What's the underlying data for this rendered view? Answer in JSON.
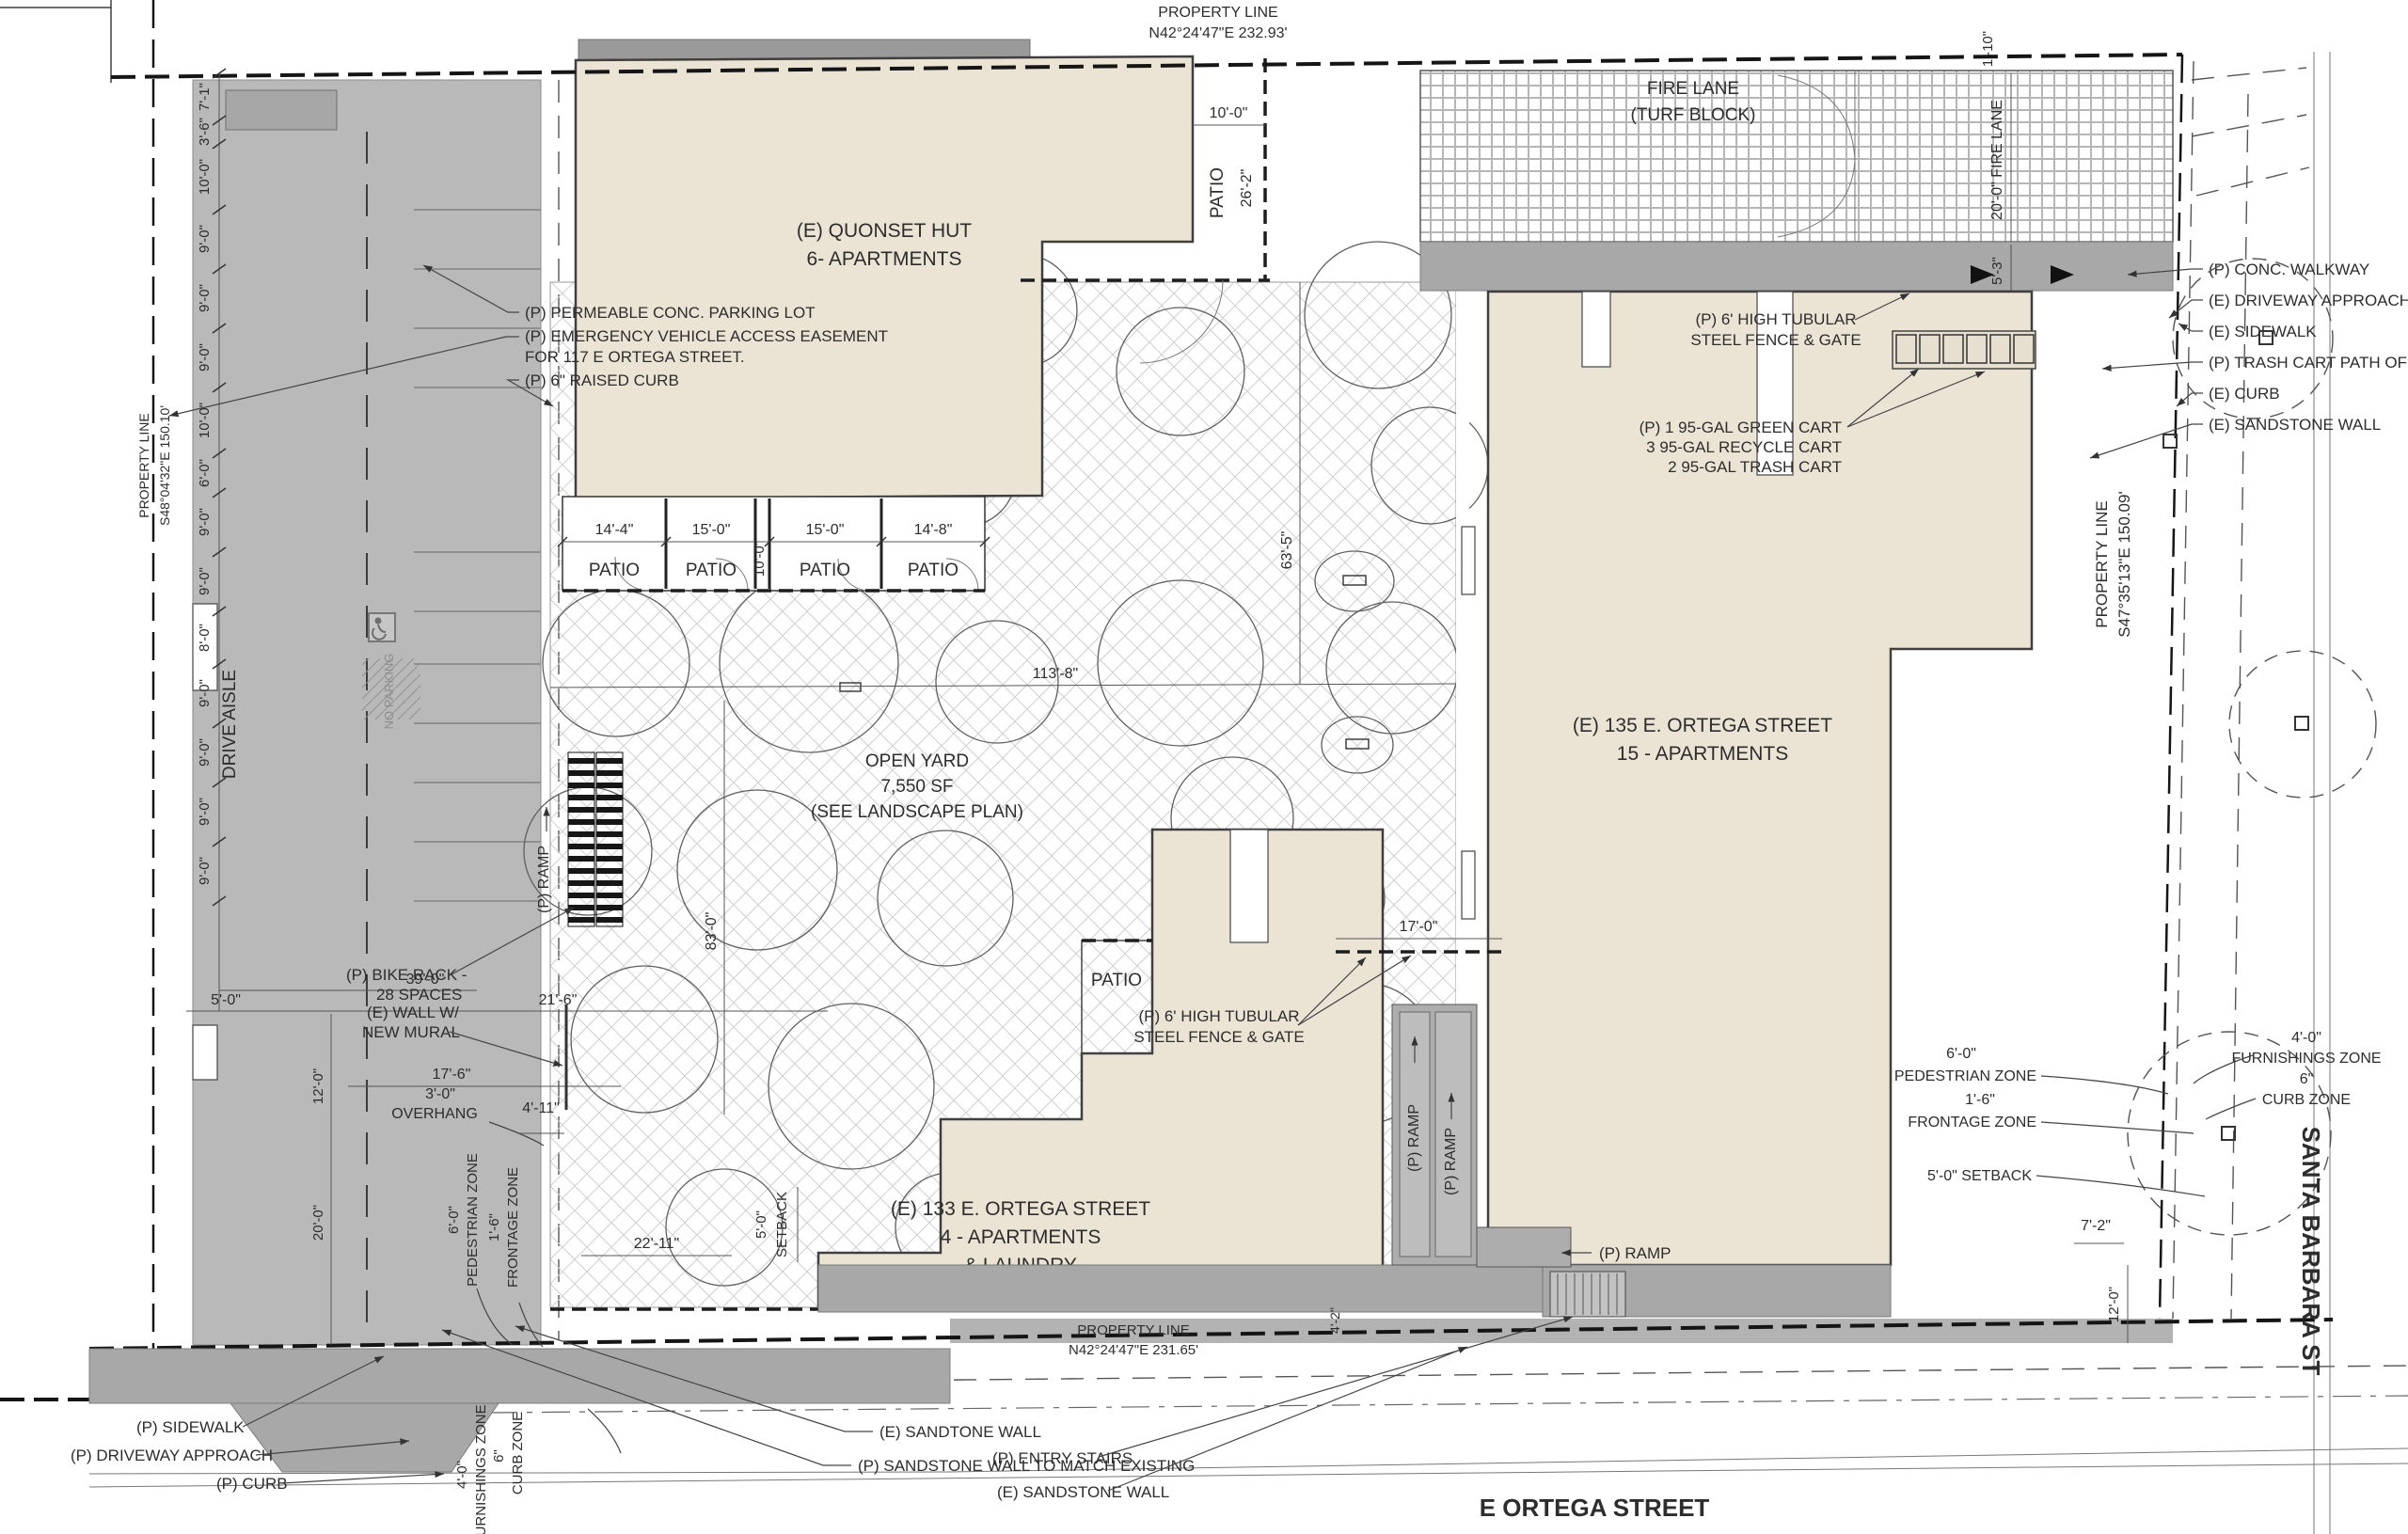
{
  "drawing": {
    "property_lines": {
      "label": "PROPERTY LINE",
      "top_bearing": "N42°24'47\"E 232.93'",
      "bottom_bearing": "N42°24'47\"E 231.65'",
      "left_bearing": "S48°04'32\"E 150.10'",
      "right_bearing": "S47°35'13\"E 150.09'"
    },
    "streets": {
      "bottom": "E ORTEGA STREET",
      "right": "SANTA BARBARA ST"
    },
    "buildings": {
      "quonset_line1": "(E) QUONSET HUT",
      "quonset_line2": "6- APARTMENTS",
      "b135_line1": "(E) 135 E. ORTEGA STREET",
      "b135_line2": "15 - APARTMENTS",
      "b133_line1": "(E) 133 E. ORTEGA STREET",
      "b133_line2": "4 - APARTMENTS",
      "b133_line3": "& LAUNDRY"
    },
    "areas": {
      "fire_lane1": "FIRE LANE",
      "fire_lane2": "(TURF BLOCK)",
      "open_yard1": "OPEN YARD",
      "open_yard2": "7,550 SF",
      "open_yard3": "(SEE LANDSCAPE PLAN)",
      "drive_aisle": "DRIVE AISLE",
      "patio": "PATIO",
      "no_parking": "NO PARKING"
    },
    "callouts": {
      "permeable": "(P) PERMEABLE CONC. PARKING LOT",
      "evae1": "(P) EMERGENCY VEHICLE ACCESS EASEMENT",
      "evae2": "FOR 117 E ORTEGA STREET.",
      "raised_curb": "(P) 6\" RAISED CURB",
      "bike_rack1": "(P) BIKE RACK -",
      "bike_rack2": "28 SPACES",
      "mural1": "(E) WALL W/",
      "mural2": "NEW MURAL",
      "conc_walkway": "(P) CONC. WALKWAY",
      "driveway_approach_e": "(E) DRIVEWAY APPROACH",
      "sidewalk_e": "(E) SIDEWALK",
      "trash_cart_path": "(P) TRASH CART PATH OF",
      "curb_e": "(E) CURB",
      "sandstone_wall_e": "(E) SANDSTONE WALL",
      "fence1": "(P) 6' HIGH TUBULAR",
      "fence2": "STEEL FENCE & GATE",
      "carts1": "(P) 1 95-GAL GREEN CART",
      "carts2": "3 95-GAL RECYCLE CART",
      "carts3": "2 95-GAL TRASH CART",
      "sidewalk_p": "(P) SIDEWALK",
      "driveway_approach_p": "(P) DRIVEWAY APPROACH",
      "curb_p": "(P) CURB",
      "sandtone_wall": "(E) SANDTONE WALL",
      "sandstone_match": "(P) SANDSTONE WALL TO MATCH EXISTING",
      "entry_stairs": "(P) ENTRY STAIRS",
      "ramp": "(P) RAMP"
    },
    "zones": {
      "pedestrian_dim": "6'-0\"",
      "pedestrian": "PEDESTRIAN ZONE",
      "frontage_dim": "1'-6\"",
      "frontage": "FRONTAGE ZONE",
      "furnishings_dim": "4'-0\"",
      "furnishings": "FURNISHINGS ZONE",
      "curb_dim": "6\"",
      "curb": "CURB ZONE",
      "setback": "5'-0\" SETBACK",
      "setback_dim": "5'-0\"",
      "setback_word": "SETBACK"
    },
    "dims": {
      "left_chain": [
        "7'-1\"",
        "3'-6\"",
        "10'-0\"",
        "9'-0\"",
        "9'-0\"",
        "9'-0\"",
        "10'-0\"",
        "6'-0\"",
        "9'-0\"",
        "9'-0\"",
        "8'-0\"",
        "9'-0\"",
        "9'-0\"",
        "9'-0\"",
        "9'-0\""
      ],
      "d39": "39'-0\"",
      "d5": "5'-0\"",
      "d21_6": "21'-6\"",
      "d17_6": "17'-6\"",
      "d12": "12'-0\"",
      "d20": "20'-0\"",
      "overhang1": "3'-0\"",
      "overhang2": "OVERHANG",
      "d4_11": "4'-11\"",
      "d22_11": "22'-11\"",
      "d83": "83'-0\"",
      "d113_8": "113'-8\"",
      "d63_5": "63'-5\"",
      "d17": "17'-0\"",
      "d10": "10'-0\"",
      "d26_2": "26'-2\"",
      "patio_dims": [
        "14'-4\"",
        "15'-0\"",
        "15'-0\"",
        "14'-8\""
      ],
      "patio_10": "10'-0\"",
      "fire_lane_20": "20'-0\" FIRE LANE",
      "d5_3": "5'-3\"",
      "d1_10": "1'-10\"",
      "d7_2": "7'-2\"",
      "d12_right": "12'-0\"",
      "d4_2": "4'-2\""
    }
  }
}
